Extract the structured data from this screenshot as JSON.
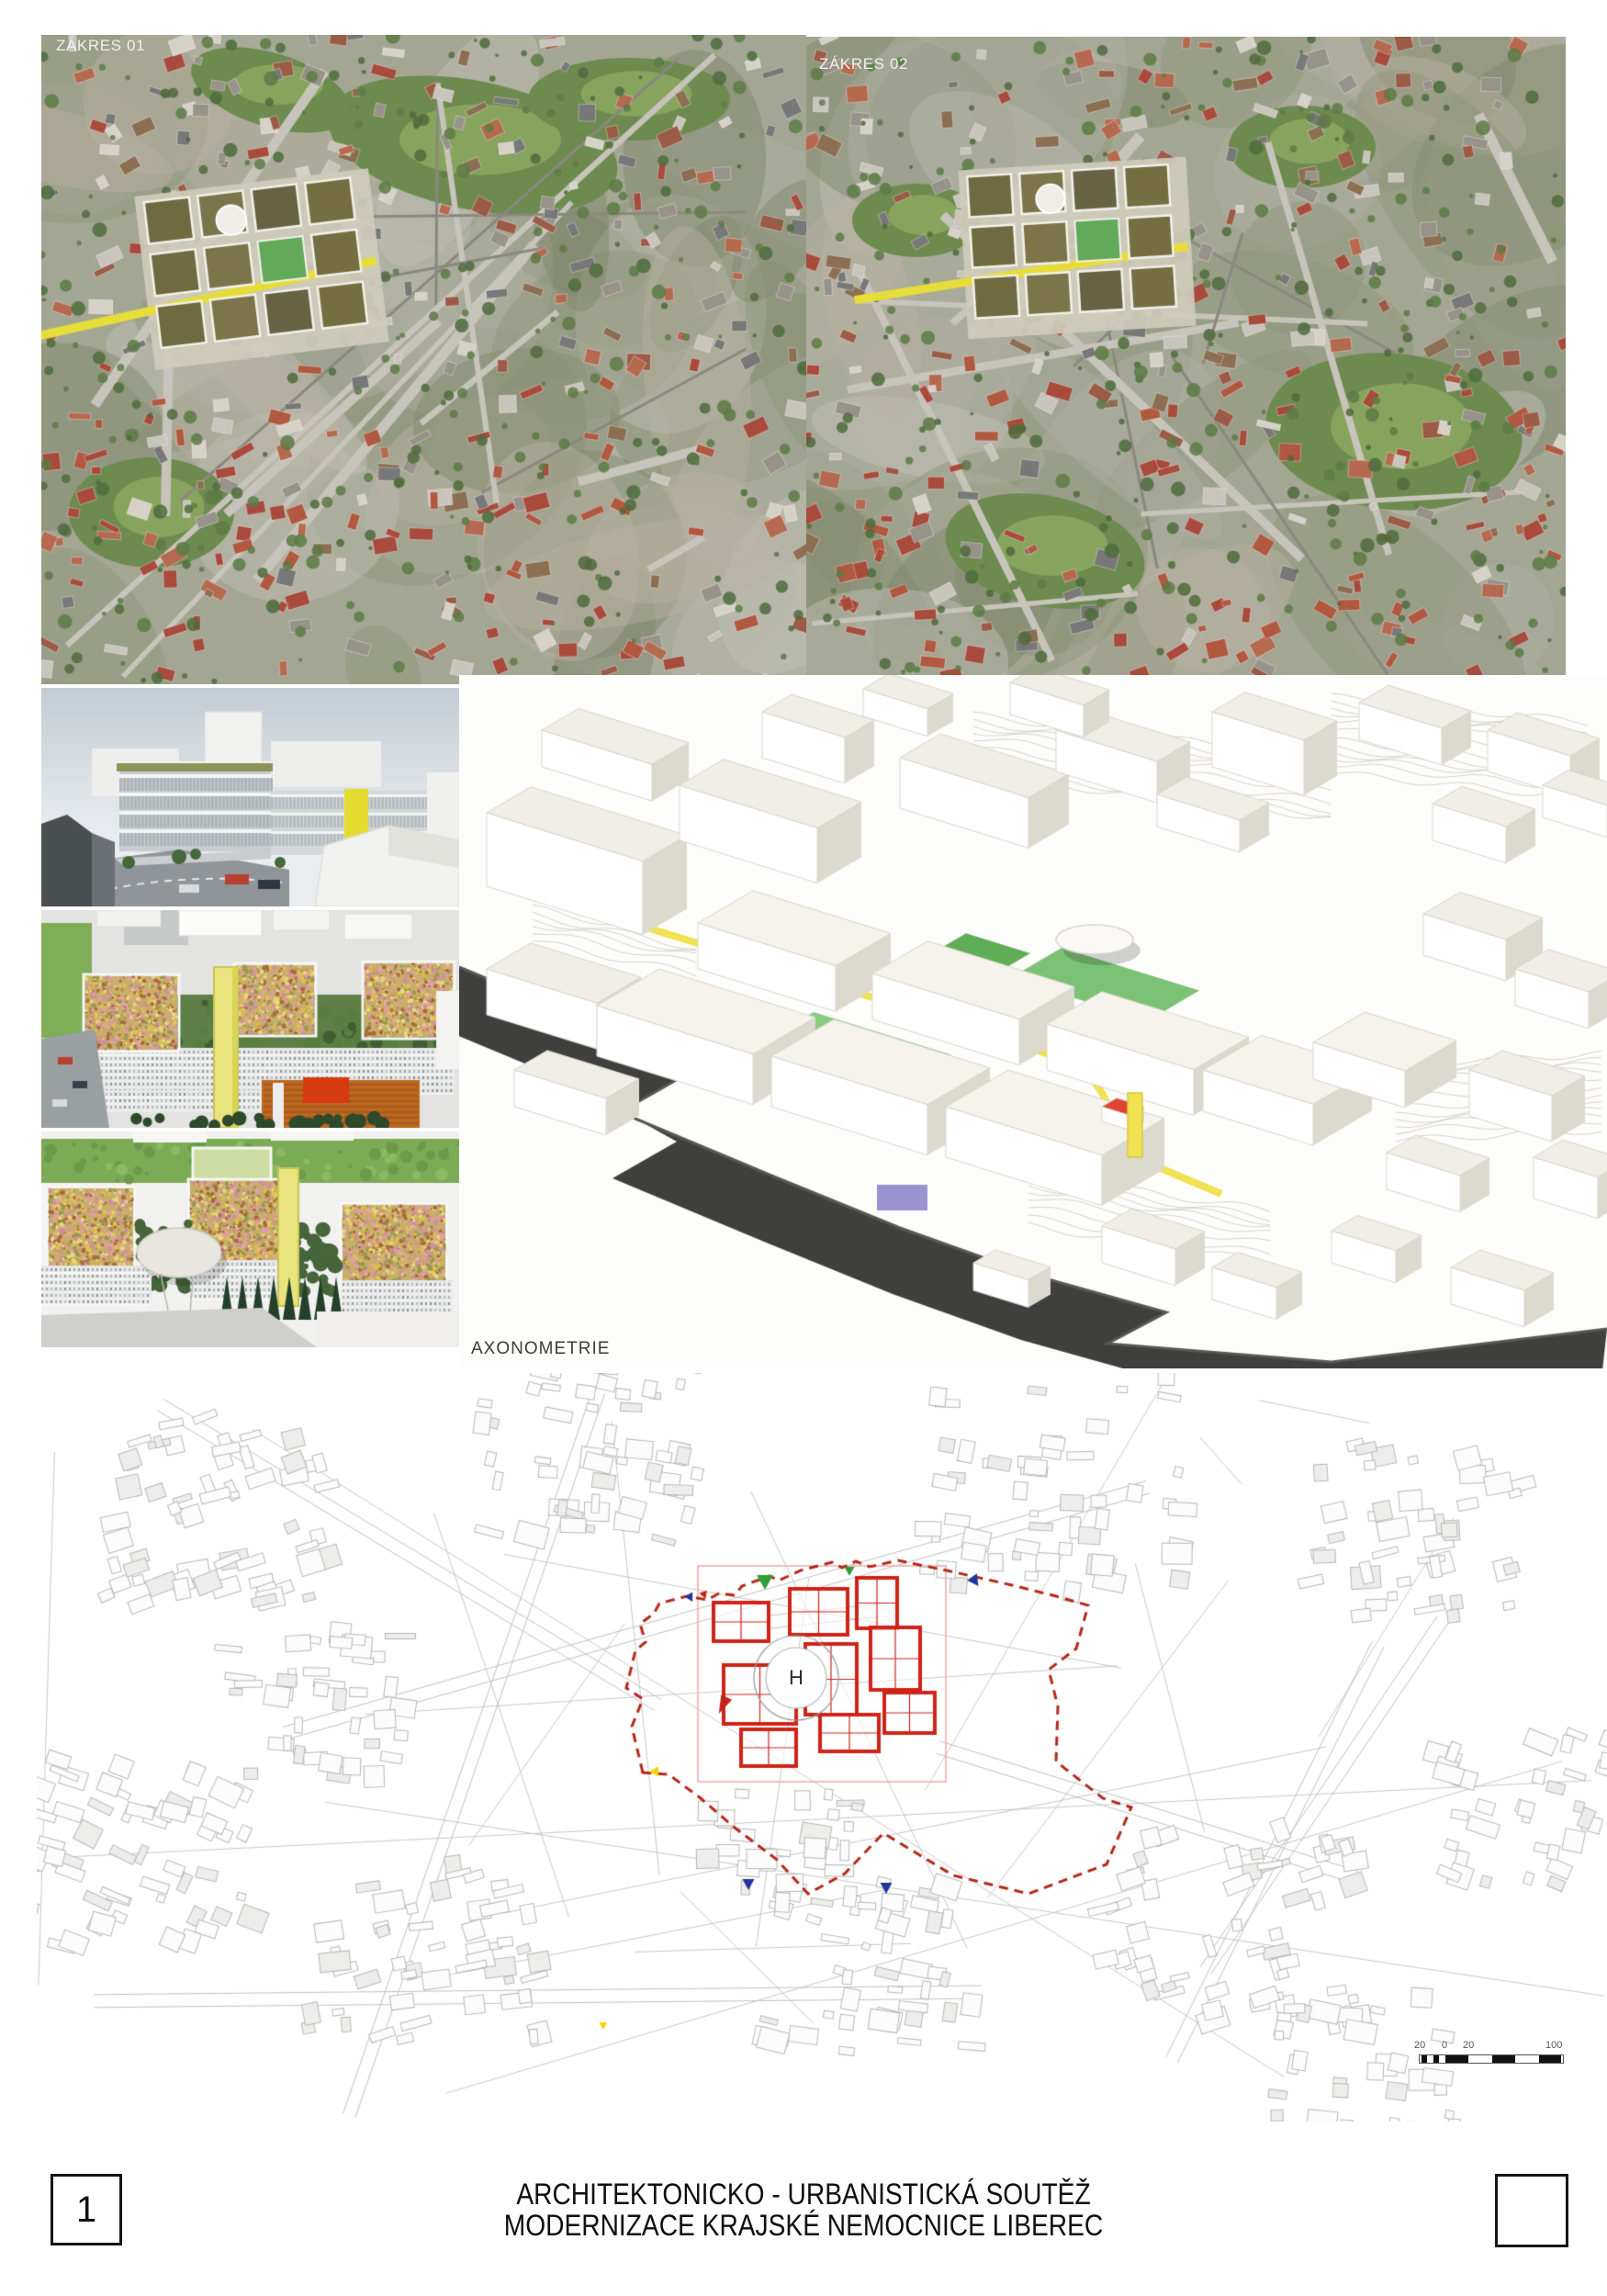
{
  "top_photos": {
    "photo1": {
      "label": "ZÁKRES 01"
    },
    "photo2": {
      "label": "ZÁKRES 02"
    }
  },
  "renders": {
    "axonometry_label": "AXONOMETRIE"
  },
  "site_plan": {
    "title": "SITUACE",
    "scale": "M1:2000",
    "helipad": "H",
    "scalebar": {
      "labels": [
        "20",
        "0",
        "20",
        "100"
      ]
    },
    "colors": {
      "proposal_red": "#cf2318",
      "boundary_red": "#b5281b",
      "marker_green": "#2f9e38",
      "marker_blue": "#24349c",
      "marker_red": "#c4231a",
      "marker_yellow": "#f2d400"
    }
  },
  "title_block": {
    "sheet_number": "1",
    "line1": "ARCHITEKTONICKO - URBANISTICKÁ SOUTĚŽ",
    "line2": "MODERNIZACE KRAJSKÉ NEMOCNICE LIBEREC"
  }
}
